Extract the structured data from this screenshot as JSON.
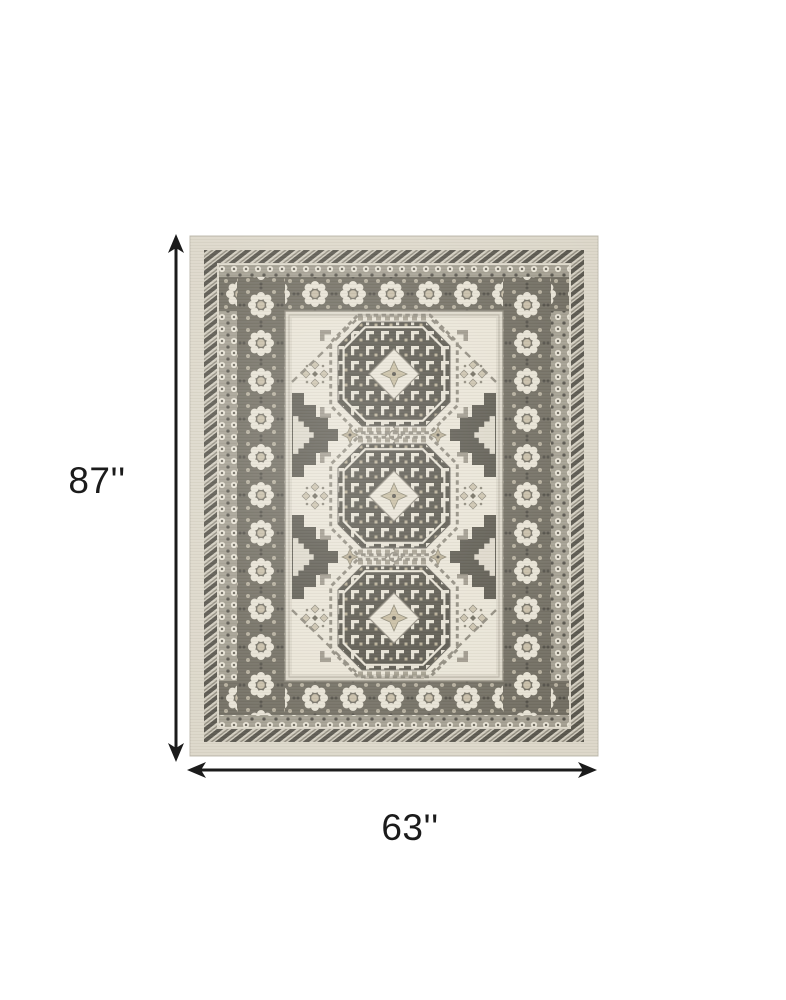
{
  "image": {
    "alt": "Top-down dimension diagram of an 87 inch by 63 inch ivory and gray oriental area rug with three octagonal medallions"
  },
  "dimensions": {
    "height_label": "87''",
    "width_label": "63''",
    "height_inches": 87,
    "width_inches": 63,
    "unit": "inches"
  },
  "icons": {
    "height_arrow": "double-headed-vertical-arrow-icon",
    "width_arrow": "double-headed-horizontal-arrow-icon"
  },
  "colors": {
    "background": "#ffffff",
    "dimension_lines": "#1b1b1b",
    "label_text": "#1b1b1b",
    "rug_outer_band": "#dcd7c9",
    "rug_field": "#e9e4d6",
    "rug_dark_accent": "#56534a",
    "rug_border_band": "#716d61",
    "rug_tan_accent": "#c6bca6"
  }
}
